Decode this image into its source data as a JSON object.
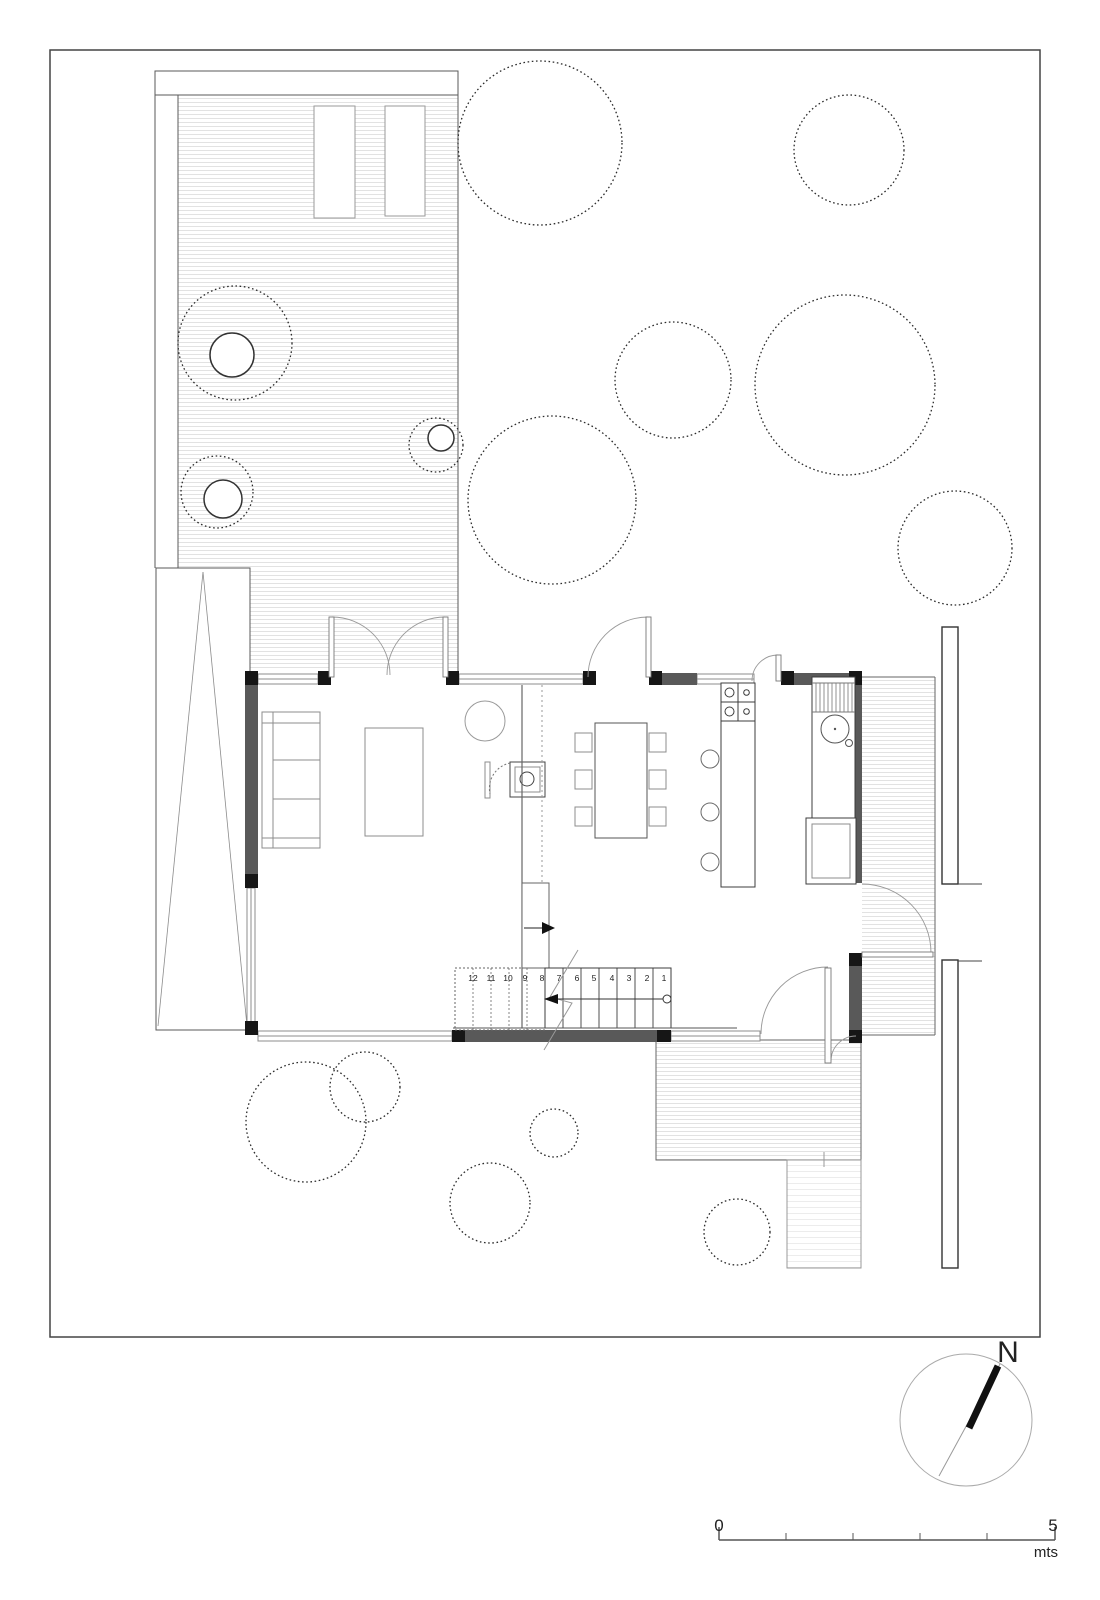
{
  "stairs": {
    "treads": [
      "12",
      "11",
      "10",
      "9",
      "8",
      "7",
      "6",
      "5",
      "4",
      "3",
      "2",
      "1"
    ]
  },
  "scale_bar": {
    "zero": "0",
    "five": "5",
    "unit": "mts"
  },
  "compass": {
    "north": "N"
  },
  "colors": {
    "paper": "#ffffff",
    "wall_fill": "#595959",
    "column_fill": "#161616",
    "outline_dark": "#3c3c3c",
    "outline_light": "#8c8c8c",
    "hatch_line": "#e2e2e2",
    "tree_dot": "#2b2b2b"
  }
}
